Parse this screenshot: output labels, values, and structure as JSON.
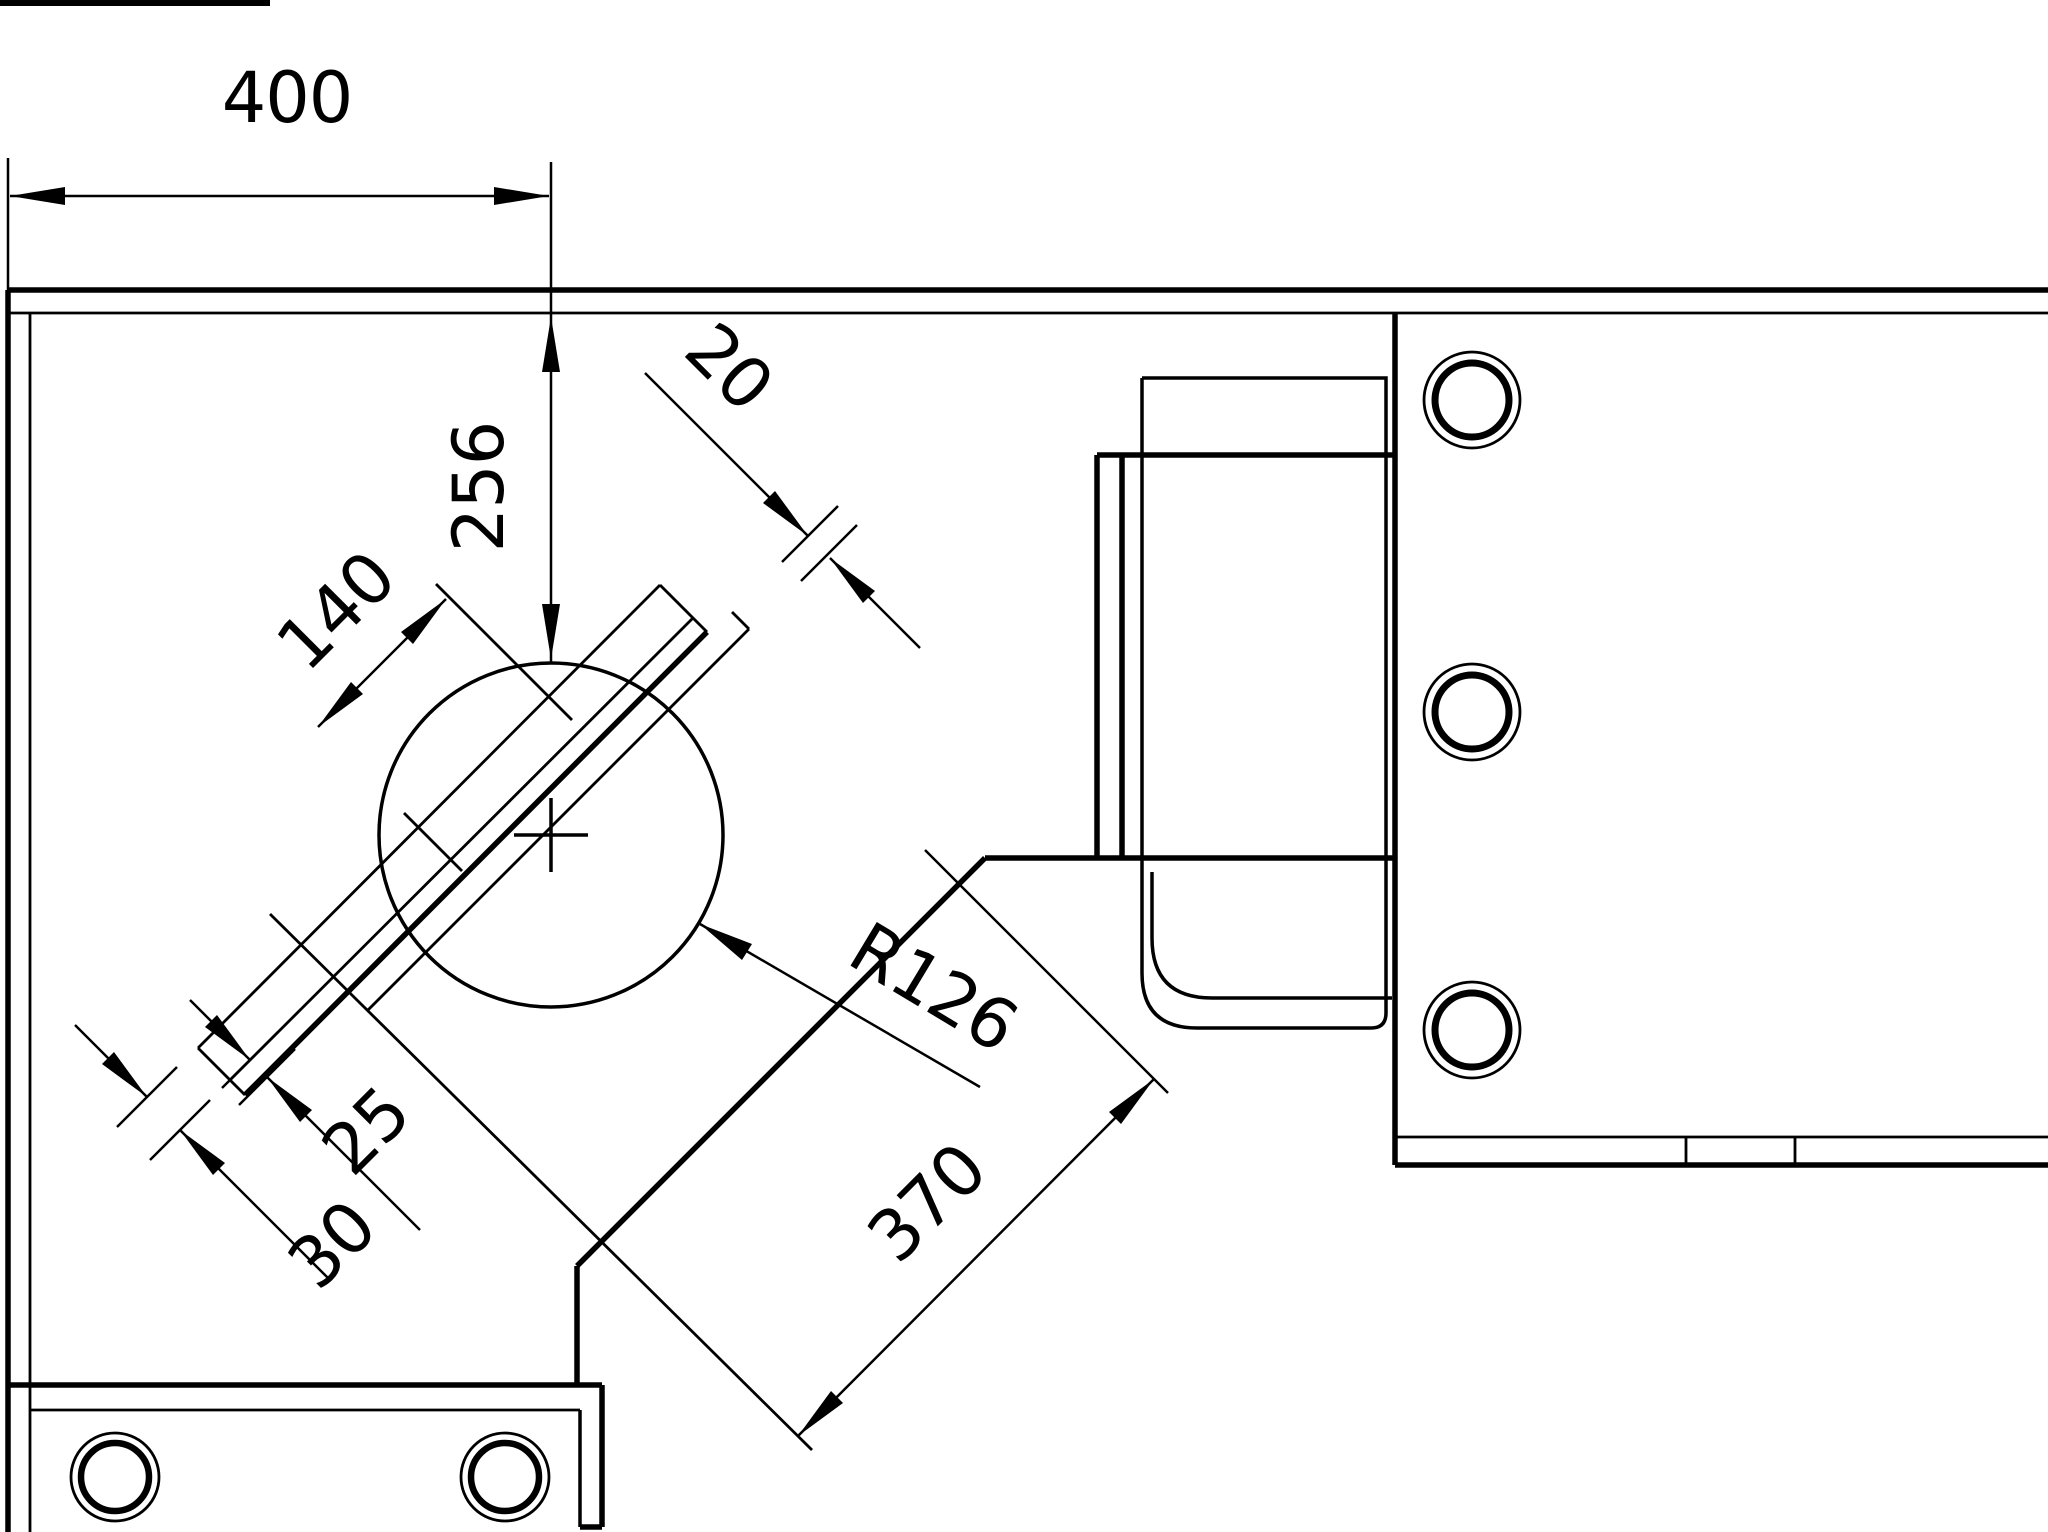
{
  "page": {
    "background_color": "#ffffff",
    "line_color": "#000000",
    "kind": "cad-technical-drawing",
    "view": "2d-orthographic-detail"
  },
  "labels": {
    "d400": "400",
    "d256": "256",
    "d20": "20",
    "d140": "140",
    "r126": "R126",
    "d25": "25",
    "d30": "30",
    "d370": "370"
  },
  "dimensions": [
    {
      "id": "d400",
      "value": 400,
      "type": "linear",
      "orientation": "horizontal",
      "measures": "offset from left edge to slot centerline"
    },
    {
      "id": "d256",
      "value": 256,
      "type": "linear",
      "orientation": "vertical",
      "measures": "offset from top edge down to circle top"
    },
    {
      "id": "d20",
      "value": 20,
      "type": "linear",
      "orientation": "diagonal-45",
      "measures": "width of narrow diagonal strip (upper right end)"
    },
    {
      "id": "d140",
      "value": 140,
      "type": "linear",
      "orientation": "diagonal-45",
      "measures": "slot length along diagonal bar"
    },
    {
      "id": "r126",
      "value": 126,
      "type": "radius",
      "orientation": "leader",
      "measures": "radius of large circle"
    },
    {
      "id": "d25",
      "value": 25,
      "type": "linear",
      "orientation": "diagonal-45",
      "measures": "strip width at lower-left bar end"
    },
    {
      "id": "d30",
      "value": 30,
      "type": "linear",
      "orientation": "diagonal-45",
      "measures": "outer strip width at lower-left bar end"
    },
    {
      "id": "d370",
      "value": 370,
      "type": "linear",
      "orientation": "diagonal-45",
      "measures": "diagonal length of angled plate edge"
    }
  ],
  "features": {
    "large_circle": {
      "radius_label": "R126",
      "has_center_cross": true
    },
    "right_flange_holes": 3,
    "bottom_foot_holes": 2,
    "diagonal_bar_angle_deg": 45
  }
}
